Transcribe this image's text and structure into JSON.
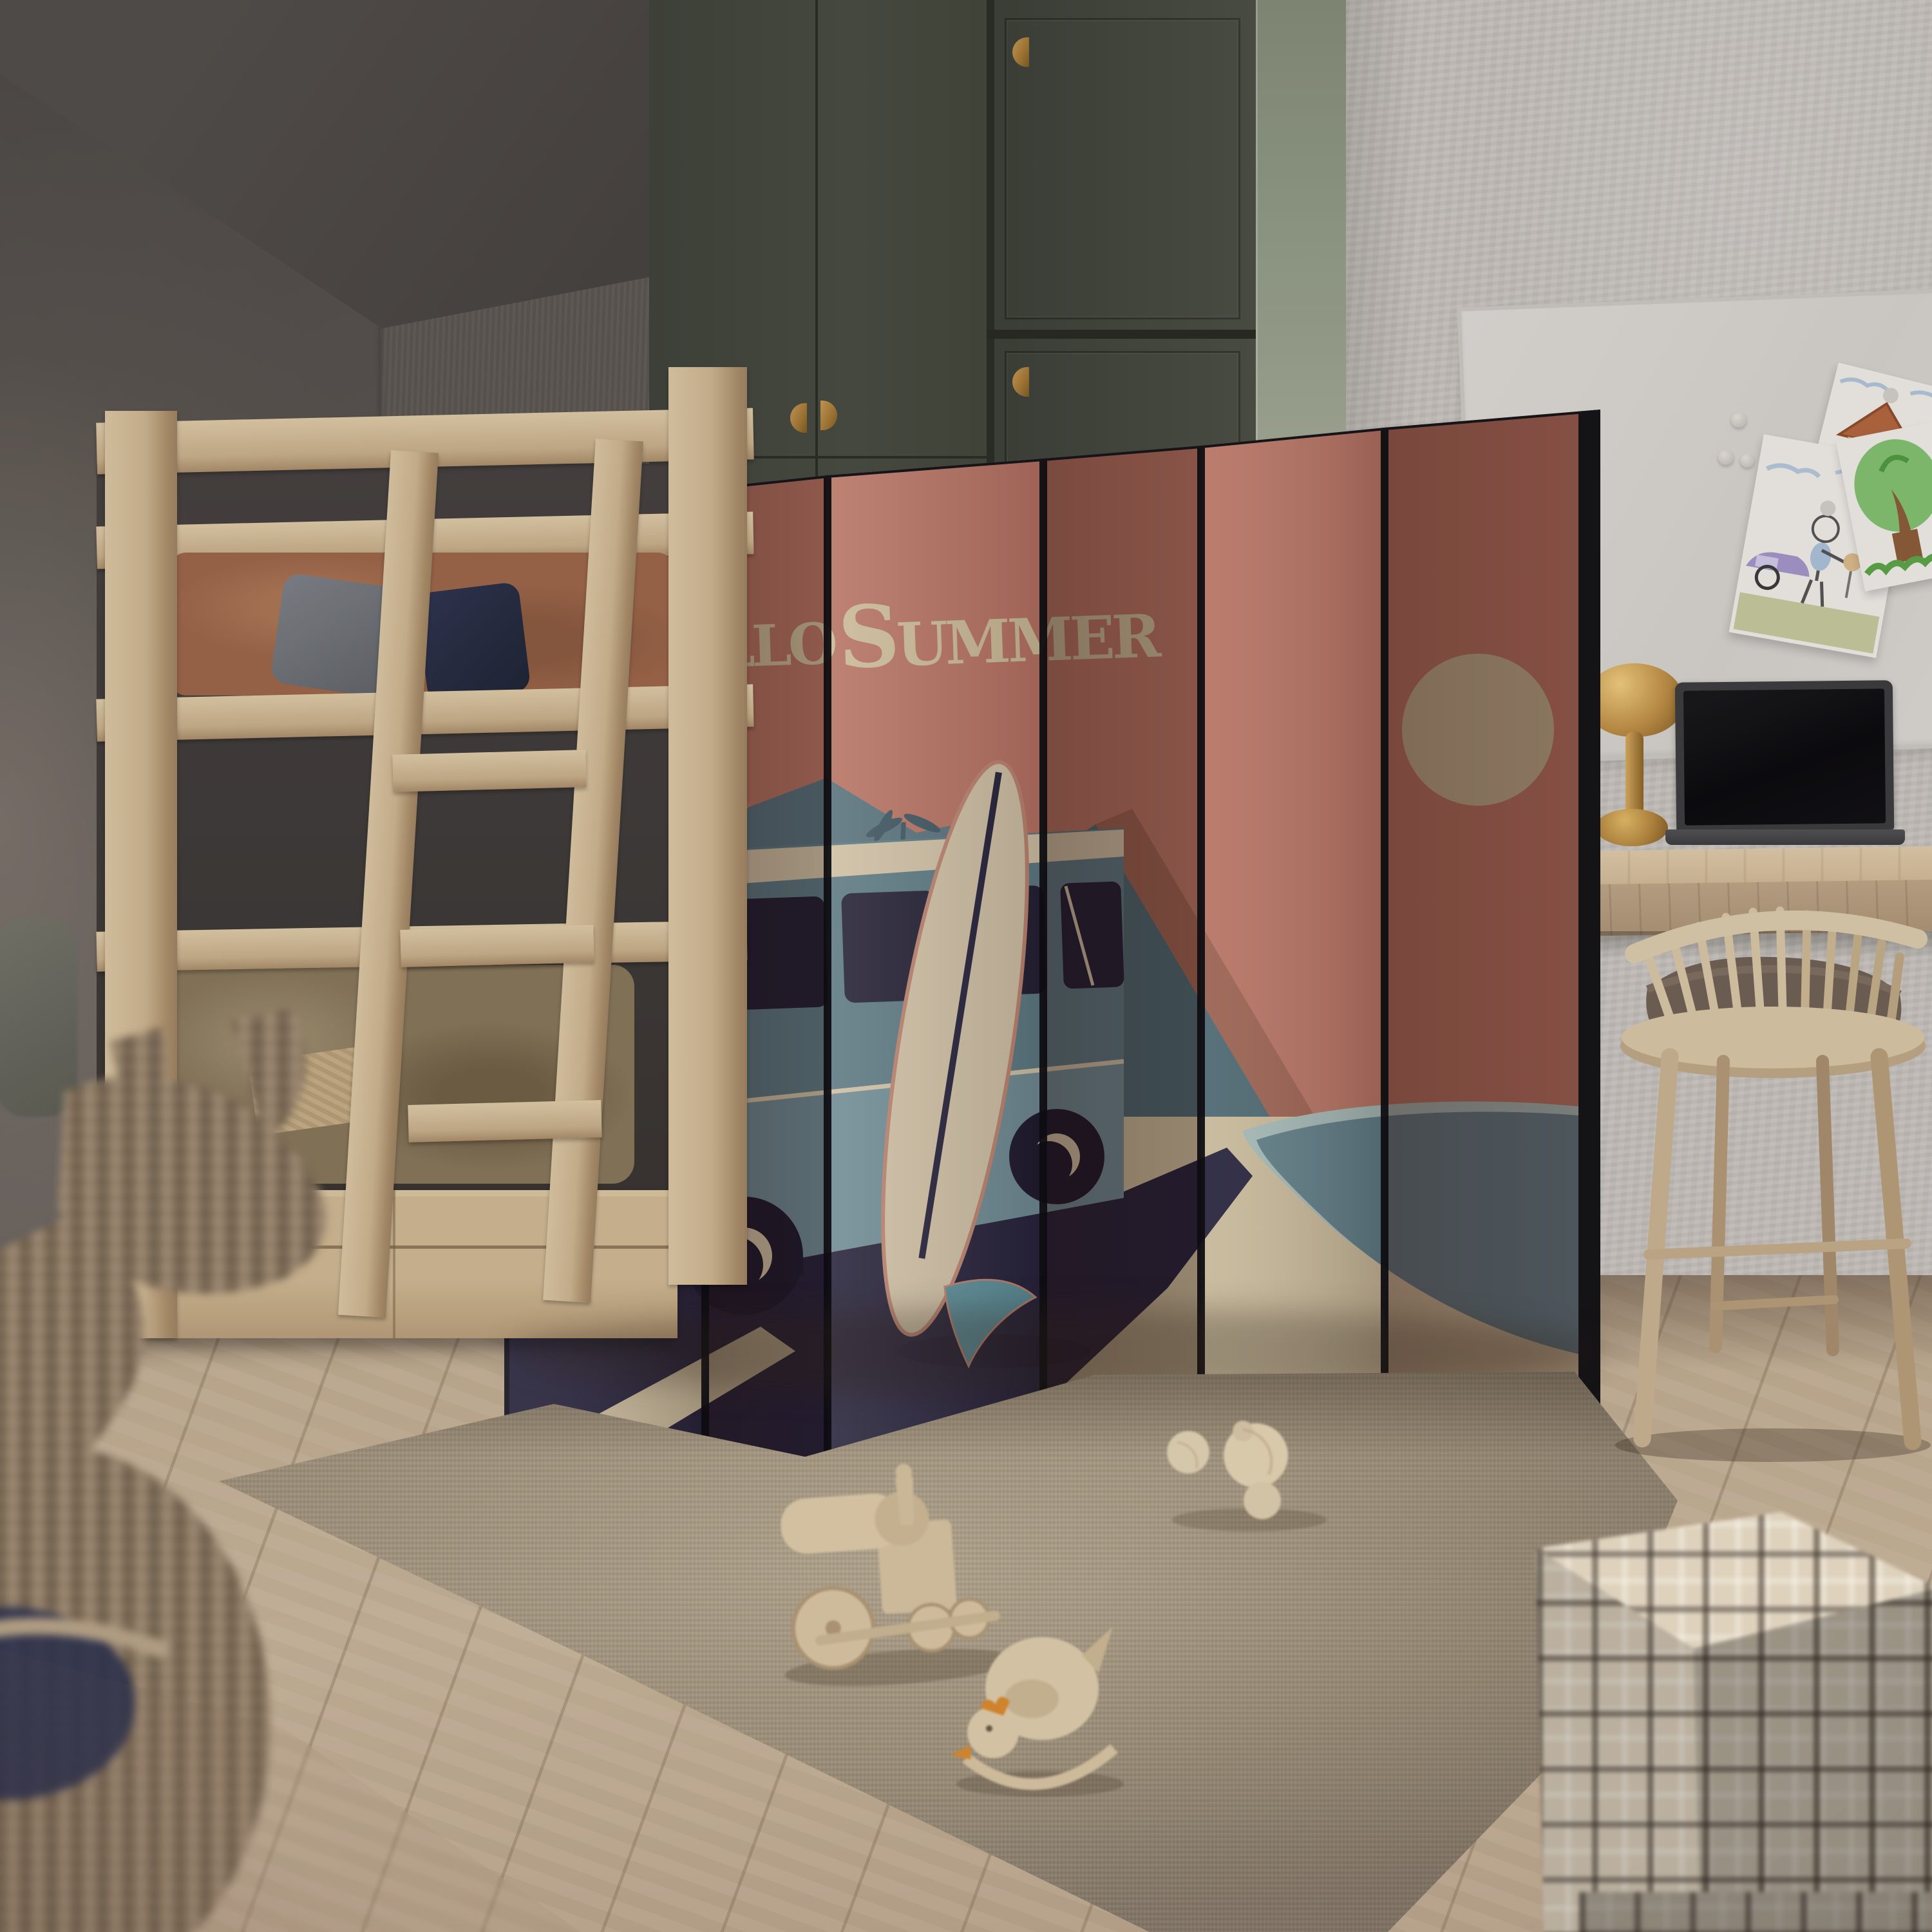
{
  "poster": {
    "title": "Hello Summer",
    "word1_initial": "H",
    "word1_rest": "ELLO",
    "word2_initial": "S",
    "word2_rest": "UMMER"
  },
  "room": {
    "description": "Children's bedroom: light-wood bunk bed at left, six-panel folding screen room divider in the centre printed with a retro 'Hello Summer' beach poster (teal camper van, surfboard, palms, lagoon and sun), olive-green wardrobe behind, whiteboard with three kids' crayon drawings and magnets, wooden desk with dark laptop and brass lamp, spindle-back chair with folded brown blanket, beige shag rug with wooden toy train, rocking chicken and wooden balls, plaid storage cubes in the right foreground and a blurred wicker donkey basket in the left foreground",
    "objects": [
      "bunk bed",
      "folding screen room divider",
      "wardrobe",
      "whiteboard",
      "kids drawings",
      "magnets",
      "desk",
      "laptop",
      "desk lamp",
      "spindle chair",
      "blanket",
      "shag rug",
      "wooden toy train",
      "wooden rocking chicken",
      "wooden balls",
      "plaid storage cubes",
      "wicker animal basket",
      "wooden floor"
    ]
  },
  "palette": {
    "divider_salmon": "#bd7969",
    "divider_salmon_dark": "#8e5747",
    "art_cream": "#d3c6a2",
    "art_navy": "#23233f",
    "art_slate_blue": "#5d808c",
    "art_water": "#60838f",
    "art_water_rim": "#a9c3c1",
    "art_sun": "#c7ba98",
    "wardrobe_green": "#43473e",
    "wardrobe_side_sage": "#99a28f",
    "wall_dark": "#57534f",
    "wall_light": "#c8c4bf",
    "wood_light": "#cdb792",
    "rug": "#ab9e89",
    "brass": "#b68a43"
  }
}
